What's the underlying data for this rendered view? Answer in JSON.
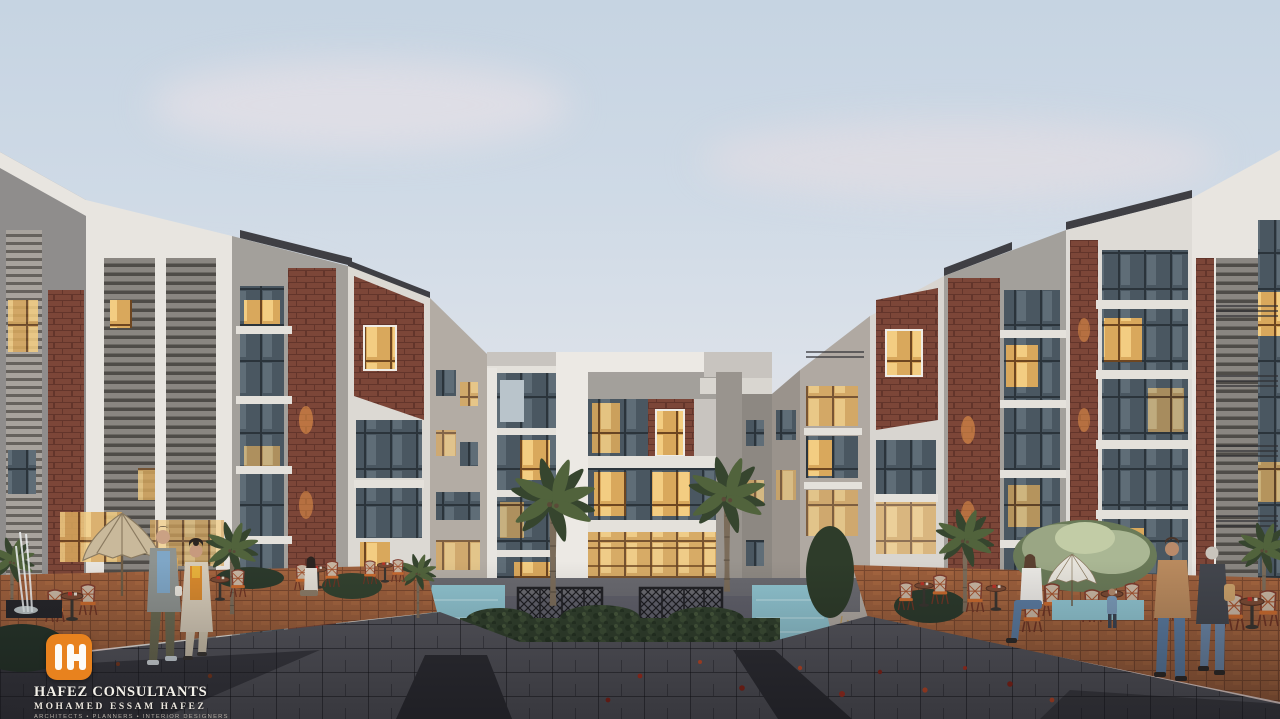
{
  "scene": {
    "type": "architectural exterior rendering",
    "setting": "residential compound courtyard plaza at dusk",
    "elements": "mirrored 4-5 story apartment buildings with white, gray and brick facades, central building, palm trees, reflecting pools, outdoor cafe terraces, pedestrians"
  },
  "watermark": {
    "monogram": "IH",
    "company": "HAFEZ CONSULTANTS",
    "principal": "MOHAMED ESSAM HAFEZ",
    "tagline": "ARCHITECTS • PLANNERS • INTERIOR DESIGNERS"
  },
  "palette": {
    "logo_orange": "#e8821e",
    "text_white": "#f2efe9",
    "sky_top": "#c6d4e2",
    "sky_horizon": "#f0dad4",
    "white_facade": "#e8e5e0",
    "concrete": "#a3a09b",
    "concrete_dark": "#8f8d8c",
    "brick": "#7c4638",
    "glass_dark": "#4a5761",
    "glass_lit": "#d9a85c",
    "window_glow": "#f2c070",
    "deck": "#9c5f3c",
    "plaza": "#55555c",
    "plaza_dark": "#2e2e34",
    "water": "#8fc3cf",
    "hedge": "#31402d",
    "palm_front": "#51633c",
    "palm_back": "#36452e",
    "trunk": "#7b6c5a",
    "umbrella_tan": "#c9b99b",
    "umbrella_white": "#e7e4dc"
  }
}
